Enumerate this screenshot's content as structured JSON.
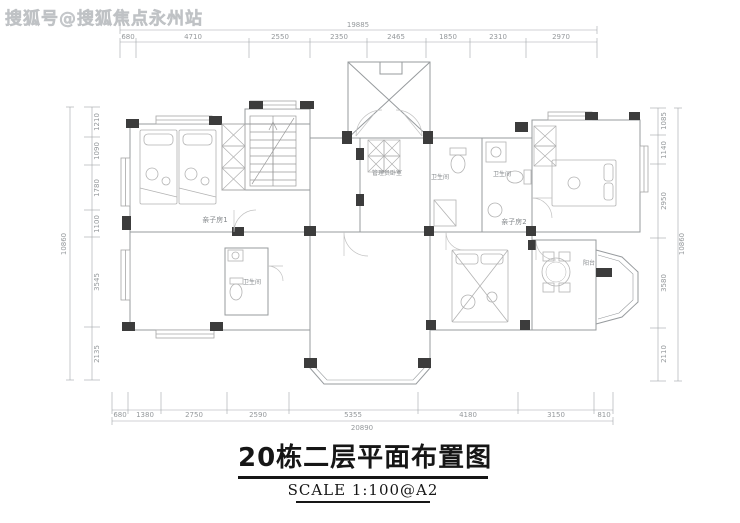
{
  "watermark": "搜狐号@搜狐焦点永州站",
  "title": {
    "text": "20栋二层平面布置图",
    "scale_label": "SCALE  1:100@A2"
  },
  "colors": {
    "dim_line": "#a2a6a9",
    "dim_text": "#95999c",
    "room_text": "#85898c",
    "wall": "#979b9e",
    "pier": "#3c3c3c"
  },
  "rooms": [
    {
      "t": "亲子房1",
      "x": 215,
      "y": 222,
      "fs": 7
    },
    {
      "t": "管理员卧室",
      "x": 387,
      "y": 175,
      "fs": 6
    },
    {
      "t": "卫生间",
      "x": 440,
      "y": 179,
      "fs": 6
    },
    {
      "t": "卫生间",
      "x": 502,
      "y": 176,
      "fs": 6
    },
    {
      "t": "亲子房2",
      "x": 514,
      "y": 224,
      "fs": 7
    },
    {
      "t": "卫生间",
      "x": 252,
      "y": 284,
      "fs": 6
    },
    {
      "t": "阳台",
      "x": 589,
      "y": 265,
      "fs": 6
    }
  ],
  "dims": {
    "top": {
      "orient": "h",
      "total": "19885",
      "total_x": 358,
      "total_y": 27,
      "total_line_y": 30,
      "x1": 120,
      "x2": 597,
      "seg_y": 42,
      "label_y": 39,
      "ext_y2": 58,
      "ticks": [
        120,
        136,
        249,
        310,
        367,
        426,
        470,
        526,
        597
      ],
      "labels": [
        {
          "t": "680",
          "x": 128
        },
        {
          "t": "4710",
          "x": 193
        },
        {
          "t": "2550",
          "x": 280
        },
        {
          "t": "2350",
          "x": 339
        },
        {
          "t": "2465",
          "x": 396
        },
        {
          "t": "1850",
          "x": 448
        },
        {
          "t": "2310",
          "x": 498
        },
        {
          "t": "2970",
          "x": 561
        }
      ]
    },
    "bottom": {
      "orient": "h",
      "total": "20890",
      "total_x": 362,
      "total_y": 430,
      "total_line_y": 421,
      "x1": 112,
      "x2": 613,
      "seg_y": 410,
      "label_y": 417,
      "ext_y2": 392,
      "ticks": [
        112,
        128,
        161,
        227,
        289,
        418,
        518,
        594,
        613
      ],
      "labels": [
        {
          "t": "680",
          "x": 120
        },
        {
          "t": "1380",
          "x": 145
        },
        {
          "t": "2750",
          "x": 194
        },
        {
          "t": "2590",
          "x": 258
        },
        {
          "t": "5355",
          "x": 353
        },
        {
          "t": "4180",
          "x": 468
        },
        {
          "t": "3150",
          "x": 556
        },
        {
          "t": "810",
          "x": 604
        }
      ]
    },
    "left": {
      "orient": "v",
      "total": "10860",
      "total_x": 66,
      "total_y": 244,
      "total_line_x": 70,
      "y1": 107,
      "y2": 380,
      "seg_x": 92,
      "label_x": 99,
      "tick_x1": 84,
      "tick_x2": 100,
      "ticks": [
        107,
        137,
        165,
        210,
        237,
        327,
        380
      ],
      "labels": [
        {
          "t": "1210",
          "y": 122
        },
        {
          "t": "1090",
          "y": 151
        },
        {
          "t": "1780",
          "y": 188
        },
        {
          "t": "1100",
          "y": 224
        },
        {
          "t": "3545",
          "y": 282
        },
        {
          "t": "2135",
          "y": 354
        }
      ]
    },
    "right": {
      "orient": "v",
      "total": "10860",
      "total_x": 684,
      "total_y": 244,
      "total_line_x": 678,
      "y1": 108,
      "y2": 381,
      "seg_x": 658,
      "label_x": 666,
      "tick_x1": 650,
      "tick_x2": 666,
      "ticks": [
        108,
        135,
        164,
        238,
        328,
        381
      ],
      "labels": [
        {
          "t": "1085",
          "y": 121
        },
        {
          "t": "1140",
          "y": 150
        },
        {
          "t": "2950",
          "y": 201
        },
        {
          "t": "3580",
          "y": 283
        },
        {
          "t": "2110",
          "y": 354
        }
      ]
    }
  }
}
